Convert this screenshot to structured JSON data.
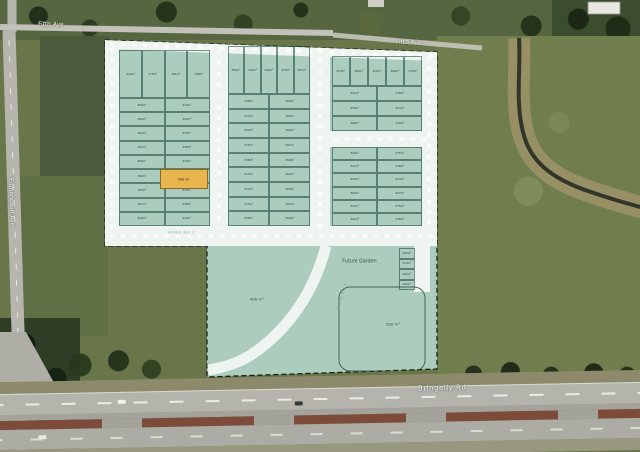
{
  "map": {
    "labels": {
      "fifth_ave_west": "Fifth Ave",
      "fifth_ave_east": "Fifth Ave",
      "bringelly_rd": "Bringelly Rd",
      "edmondson_ave": "Edmondson Ave",
      "road_no_2": "ROAD NO 2",
      "road_no_4": "ROAD NO 4",
      "future_garden": "Future Garden"
    },
    "colors": {
      "overlay_teal": "#b2d4c8",
      "road_white": "#eef4f0",
      "highlight_orange": "#e9b54e",
      "boundary_dash": "#15201c",
      "creek_dark": "#32362a",
      "creek_bank_tan": "#9d9368"
    }
  },
  "plan": {
    "highlight_area": "300 m²",
    "parcel_left_area": "400 m²",
    "parcel_right_area": "500 m²",
    "lot_area_cycle": [
      "300m²",
      "375m²",
      "301m²",
      "338m²",
      "450m²",
      "413m²",
      "360m²",
      "322m²"
    ],
    "blocks": [
      {
        "id": "block-a",
        "x": 119,
        "y": 50,
        "w": 91,
        "h": 176,
        "top_row": {
          "count": 4,
          "h": 48
        },
        "rows": 9,
        "cols": 2
      },
      {
        "id": "block-b",
        "x": 228,
        "y": 46,
        "w": 82,
        "h": 180,
        "top_row": {
          "count": 5,
          "h": 48
        },
        "rows": 9,
        "cols": 2
      },
      {
        "id": "block-c1",
        "x": 332,
        "y": 56,
        "w": 90,
        "h": 75,
        "top_row": {
          "count": 5,
          "h": 30
        },
        "rows": 3,
        "cols": 2
      },
      {
        "id": "block-c2",
        "x": 332,
        "y": 147,
        "w": 90,
        "h": 79,
        "top_row": null,
        "rows": 6,
        "cols": 2
      },
      {
        "id": "block-d",
        "x": 399,
        "y": 248,
        "w": 16,
        "h": 42,
        "top_row": null,
        "rows": 4,
        "cols": 1
      }
    ]
  }
}
